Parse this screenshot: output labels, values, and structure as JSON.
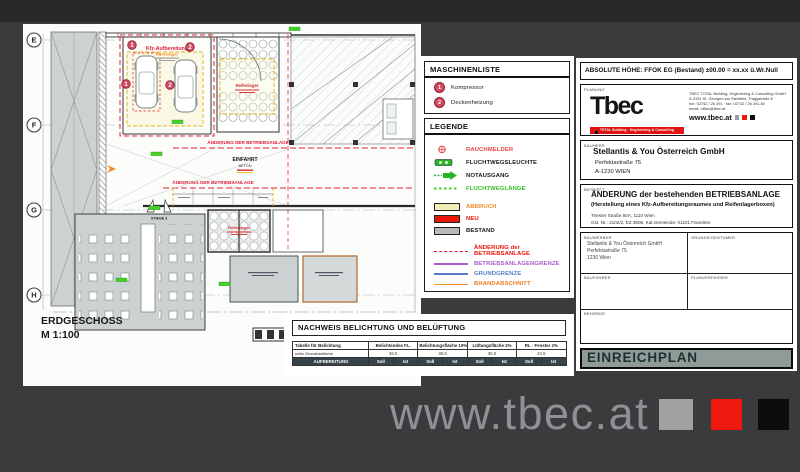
{
  "colors": {
    "background": "#3a3b3d",
    "sheet": "#fcfcfa",
    "accent_red": "#e0203a",
    "neu_red": "#ea1408",
    "abbruch_fill": "#f2edb4",
    "bestand_gray": "#b5bbbd",
    "safety_green": "#2fbf22",
    "grenze_purple": "#a85cc8",
    "grund_blue": "#5a7ad0",
    "brand_orange": "#f09030",
    "einreichplan_bar": "#8e9b99",
    "watermark_gray": "#909094",
    "watermark_red": "#ee1810"
  },
  "plan": {
    "grid_labels": [
      "E",
      "F",
      "G",
      "H"
    ],
    "title": "ERDGESCHOSS",
    "scale": "M 1:100",
    "labels": {
      "kfz_room": "Kfz-Aufbereitung",
      "kfz_room_sub": "Reifenlager",
      "reifenlager_oben": "Reifenlager",
      "reifenlager_boxen": "Reifenlager",
      "aenderung_1": "ÄNDERUNG DER BETRIEBSANLAGE",
      "aenderung_2": "ÄNDERUNG DER BETRIEBSANLAGE",
      "einfahrt": "EINFAHRT",
      "beton": "BETON",
      "stiege": "STIEGE 3",
      "marker_1": "1",
      "marker_2": "2"
    }
  },
  "maschinenliste": {
    "title": "MASCHINENLISTE",
    "items": [
      {
        "num": "1",
        "label": "Kompressor"
      },
      {
        "num": "2",
        "label": "Deckenheizung"
      }
    ]
  },
  "legende": {
    "title": "LEGENDE",
    "symbols": [
      {
        "label": "RAUCHMELDER"
      },
      {
        "label": "FLUCHTWEGSLEUCHTE"
      },
      {
        "label": "NOTAUSGANG"
      },
      {
        "label": "FLUCHTWEGLÄNGE"
      }
    ],
    "areas": [
      {
        "label": "ABBRUCH"
      },
      {
        "label": "NEU"
      },
      {
        "label": "BESTAND"
      }
    ],
    "lines": [
      {
        "label": "ÄNDERUNG der BETRIEBSANLAGE"
      },
      {
        "label": "BETRIEBSANLAGENGRENZE"
      },
      {
        "label": "GRUNDGRENZE"
      },
      {
        "label": "BRANDABSCHNITT"
      }
    ]
  },
  "nachweis": {
    "title": "NACHWEIS BELICHTUNG UND BELÜFTUNG",
    "col0_header": "Tabelle für Belichtung",
    "col_groups": [
      "Belichtendes FL.",
      "Belichtungsfläche 10%",
      "Lüftungsfläche 2%",
      "RL - Fenster 2%"
    ],
    "row_area_label": "netto Grundrissfläche",
    "row_area_values": [
      "36.5",
      "36.5",
      "36.5",
      "34.5"
    ],
    "row_room_label": "AUFBEREITUNG",
    "soll": "Soll",
    "ist": "Ist"
  },
  "titleblock": {
    "absolute_hoehe": "ABSOLUTE HÖHE: FFOK EG (Bestand) ±00.00 = xx.xx ü.Wr.Null",
    "planung": {
      "label": "PLANUNG",
      "logo_text": "Tbec",
      "logo_tagline": "TOTAL Building · Engineering & Consulting",
      "address_lines": [
        "TBEC TOTAL Building, Engineering & Consulting GmbH",
        "A-3151 St. Georgen am Steinfeld, Traggstraße 8",
        "fon: 02742 / 26 391 · fax: 02742 / 26 391-60",
        "email: office@tbec.at"
      ],
      "web": "www.tbec.at"
    },
    "bauherr": {
      "label": "BAUHERR",
      "name": "Stellantis & You Österreich GmbH",
      "address_1": "Perfektastraße 75",
      "address_2": "A-1230 WIEN"
    },
    "betrifft": {
      "label": "BETRIFFT",
      "line_1": "ÄNDERUNG der bestehenden BETRIEBSANLAGE",
      "line_2": "(Herstellung eines Kfz-Aufbereitungsraumes und Reifenlagerboxen)",
      "line_3": "Triester Straße 50A, 1110 Wien",
      "line_4": "Gst. Nr.: 2102/2, EZ 3505, Kat.Gemeinde: 01101 Favoriten"
    },
    "parties": {
      "bauwerber_label": "BAUWERBER",
      "bauwerber_lines": [
        "Stellantis & You Österreich GmbH",
        "Perfektastraße 75",
        "1230 Wien"
      ],
      "grundeigentuemer_label": "GRUNDEIGENTÜMER",
      "baufuehrer_label": "BAUFÜHRER",
      "planverfasser_label": "PLANVERFASSER",
      "behoerde_label": "BEHÖRDE"
    },
    "plan_type": "EINREICHPLAN"
  },
  "watermark": {
    "text": "www.tbec.at"
  }
}
